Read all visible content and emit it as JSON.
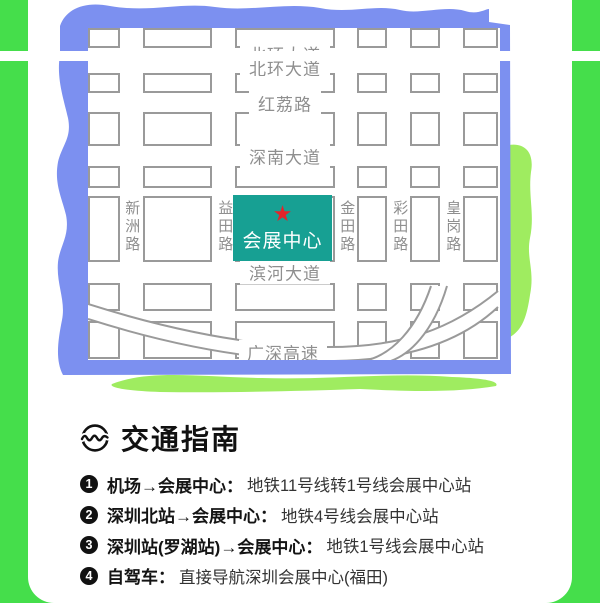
{
  "colors": {
    "background_green": "#45DE4B",
    "accent_light_green": "#9FEC60",
    "frame_blue": "#7C90F0",
    "center_teal": "#17A093",
    "star_red": "#E3242B",
    "road_gray": "#8F8F8F"
  },
  "map": {
    "center": {
      "label": "会展中心",
      "star_glyph": "★"
    },
    "horizontal_roads": [
      "北环大道",
      "红荔路",
      "深南大道",
      "滨河大道",
      "广深高速"
    ],
    "vertical_roads": [
      "新洲路",
      "益田路",
      "金田路",
      "彩田路",
      "皇岗路"
    ]
  },
  "transport": {
    "title": "交通指南",
    "items": [
      {
        "num": "1",
        "route": "机场→会展中心：",
        "detail": "地铁11号线转1号线会展中心站"
      },
      {
        "num": "2",
        "route": "深圳北站→会展中心：",
        "detail": "地铁4号线会展中心站"
      },
      {
        "num": "3",
        "route": "深圳站(罗湖站)→会展中心：",
        "detail": "地铁1号线会展中心站"
      },
      {
        "num": "4",
        "route": "自驾车：",
        "detail": "直接导航深圳会展中心(福田)"
      }
    ]
  }
}
